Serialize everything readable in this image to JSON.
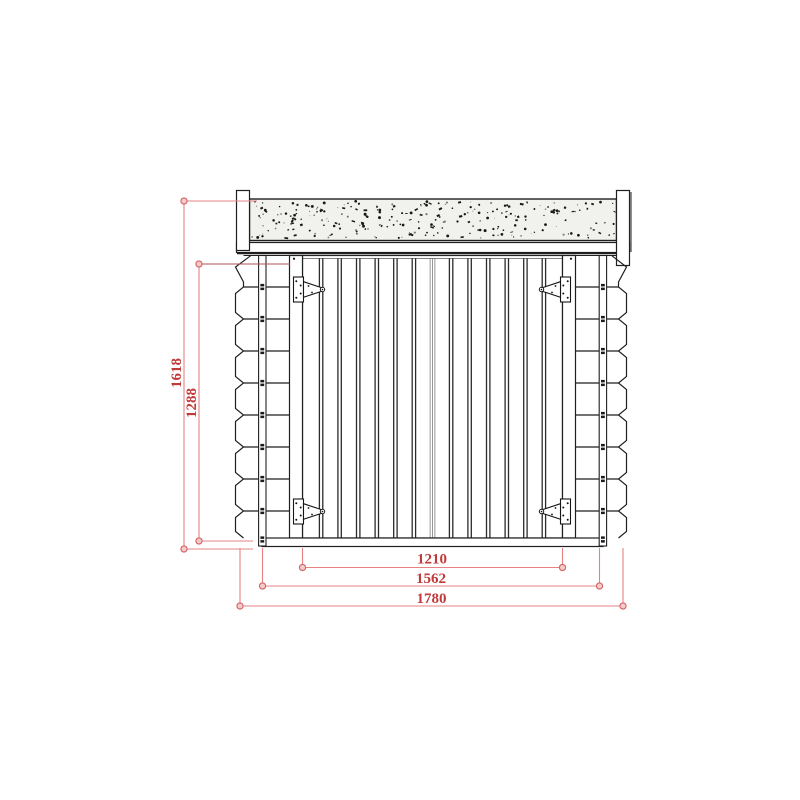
{
  "drawing": {
    "type": "technical-elevation",
    "subject": "log cabin front elevation with double plank doors",
    "dimensions": {
      "total_height": "1618",
      "wall_height": "1288",
      "door_width": "1210",
      "wall_width": "1562",
      "roof_width": "1780"
    },
    "colors": {
      "outline": "#1f1f1f",
      "plank_line": "#2b2b2b",
      "dim_line": "#e58383",
      "dim_line_dark": "#b05050",
      "dim_end_stroke": "#d26464",
      "dim_end_fill": "#f6caca",
      "dim_text": "#c13a3a",
      "roof_fill": "#f1f1ee",
      "speckle": "#181818",
      "white": "#ffffff"
    }
  }
}
